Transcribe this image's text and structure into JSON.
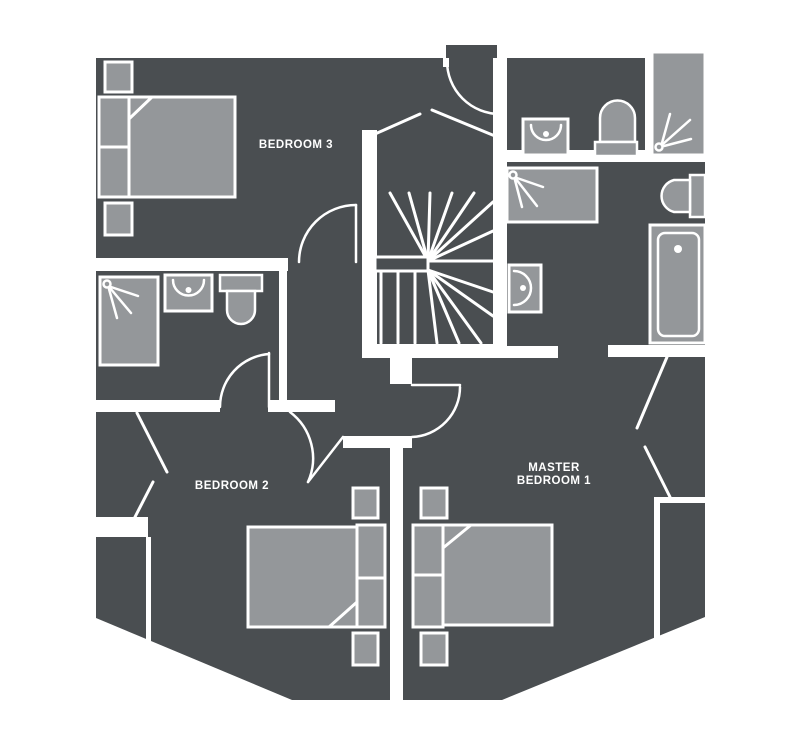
{
  "colors": {
    "floor": "#4a4e51",
    "fixture": "#94979a",
    "wall": "#ffffff"
  },
  "rooms": {
    "bedroom3": {
      "label": "BEDROOM 3"
    },
    "bedroom2": {
      "label": "BEDROOM 2"
    },
    "master_bedroom1": {
      "label_line1": "MASTER",
      "label_line2": "BEDROOM 1"
    }
  },
  "icons": {
    "shower": "shower-spray-icon",
    "basin": "wash-basin-icon",
    "toilet": "toilet-icon",
    "bathtub": "bathtub-icon",
    "bed": "double-bed-icon",
    "nightstand": "nightstand-icon",
    "stairs": "winder-stairs-icon",
    "door": "door-swing-icon",
    "window": "window-icon"
  }
}
